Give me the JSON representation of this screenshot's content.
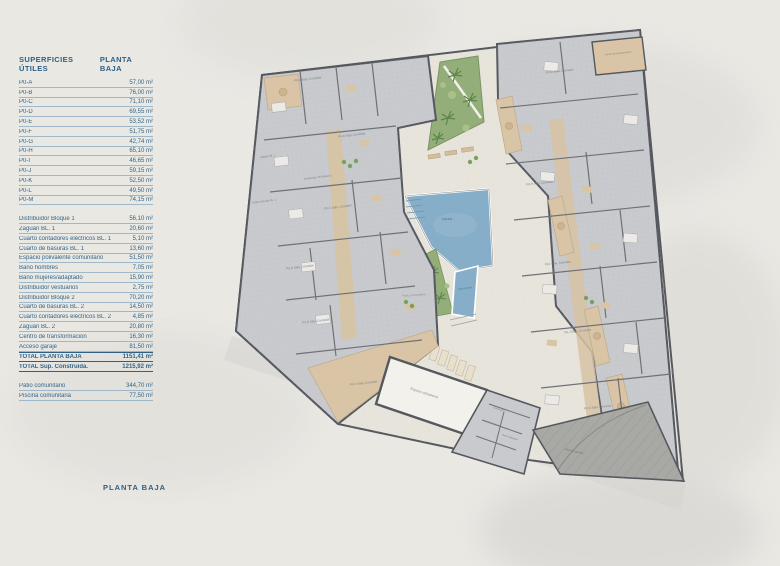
{
  "table": {
    "header_left": "SUPERFICIES ÚTILES",
    "header_right": "PLANTA BAJA",
    "unit_rows": [
      {
        "label": "P0-A",
        "value": "57,00 m²"
      },
      {
        "label": "P0-B",
        "value": "76,00 m²"
      },
      {
        "label": "P0-C",
        "value": "71,10 m²"
      },
      {
        "label": "P0-D",
        "value": "69,55 m²"
      },
      {
        "label": "P0-E",
        "value": "53,52 m²"
      },
      {
        "label": "P0-F",
        "value": "51,75 m²"
      },
      {
        "label": "P0-G",
        "value": "42,74 m²"
      },
      {
        "label": "P0-H",
        "value": "65,10 m²"
      },
      {
        "label": "P0-I",
        "value": "46,65 m²"
      },
      {
        "label": "P0-J",
        "value": "59,15 m²"
      },
      {
        "label": "P0-K",
        "value": "52,50 m²"
      },
      {
        "label": "P0-L",
        "value": "49,50 m²"
      },
      {
        "label": "P0-M",
        "value": "74,15 m²"
      }
    ],
    "common_rows": [
      {
        "label": "Distribuidor Bloque 1",
        "value": "56,10 m²"
      },
      {
        "label": "Zaguán BL. 1",
        "value": "20,60 m²"
      },
      {
        "label": "Cuarto contadores eléctricos BL. 1",
        "value": "5,10 m²"
      },
      {
        "label": "Cuarto de basuras BL. 1",
        "value": "13,60 m²"
      },
      {
        "label": "Espacio polivalente comunitario",
        "value": "51,50 m²"
      },
      {
        "label": "Baño hombres",
        "value": "7,05 m²"
      },
      {
        "label": "Baño mujeres/adaptado",
        "value": "15,90 m²"
      },
      {
        "label": "Distribuidor vestuarios",
        "value": "2,75 m²"
      },
      {
        "label": "Distribuidor Bloque 2",
        "value": "70,20 m²"
      },
      {
        "label": "Cuarto de basuras BL. 2",
        "value": "14,50 m²"
      },
      {
        "label": "Cuarto contadores eléctricos BL. 2",
        "value": "4,85 m²"
      },
      {
        "label": "Zaguán BL. 2",
        "value": "20,80 m²"
      },
      {
        "label": "Centro de transformación",
        "value": "16,30 m²"
      },
      {
        "label": "Acceso garaje",
        "value": "81,50 m²"
      }
    ],
    "total_rows": [
      {
        "label": "TOTAL PLANTA BAJA",
        "value": "1151,41 m²"
      },
      {
        "label": "TOTAL Sup. Construida.",
        "value": "1215,92 m²"
      }
    ],
    "extra_rows": [
      {
        "label": "Patio comunitario",
        "value": "344,70 m²"
      },
      {
        "label": "Piscina comunitaria",
        "value": "77,50 m²"
      }
    ]
  },
  "footer": {
    "title": "PLANTA BAJA"
  },
  "plan": {
    "colors": {
      "text_blue": "#2c5f85",
      "block_gray": "#c8cace",
      "wall": "#55585e",
      "terrace_beige": "#d9c5a6",
      "garden_green": "#93ae78",
      "pool_blue": "#87aec8",
      "ramp_gray": "#a8a8a4"
    },
    "labels": [
      {
        "t": "P0-A Sala. Comedor",
        "x": 308,
        "y": 80,
        "r": -7,
        "s": 3
      },
      {
        "t": "P0-B Sala. Comedor",
        "x": 352,
        "y": 136,
        "r": -7,
        "s": 3
      },
      {
        "t": "P0-C Sala. Comedor",
        "x": 338,
        "y": 208,
        "r": -7,
        "s": 3
      },
      {
        "t": "P0-D Sala. Comedor",
        "x": 300,
        "y": 268,
        "r": -7,
        "s": 3
      },
      {
        "t": "P0-E Sala. Comedor",
        "x": 316,
        "y": 322,
        "r": -7,
        "s": 3
      },
      {
        "t": "P0-F Sala. Comedor",
        "x": 364,
        "y": 384,
        "r": -7,
        "s": 3
      },
      {
        "t": "P0-G Sala. Comedor",
        "x": 560,
        "y": 72,
        "r": -6,
        "s": 3
      },
      {
        "t": "P0-H Sala. Comedor",
        "x": 540,
        "y": 184,
        "r": -6,
        "s": 3
      },
      {
        "t": "P0-I Sala. Comedor",
        "x": 558,
        "y": 264,
        "r": -6,
        "s": 3
      },
      {
        "t": "P0-J Sala. Comedor",
        "x": 578,
        "y": 332,
        "r": -6,
        "s": 3
      },
      {
        "t": "P0-K Sala. Comedor",
        "x": 598,
        "y": 408,
        "r": -6,
        "s": 3
      },
      {
        "t": "Zaguán BL. 1",
        "x": 268,
        "y": 157,
        "r": -7,
        "s": 2.6
      },
      {
        "t": "Distribuidor P0 Bloque 1",
        "x": 318,
        "y": 178,
        "r": -7,
        "s": 2.6
      },
      {
        "t": "Cuarto basuras BL. 1",
        "x": 264,
        "y": 202,
        "r": -7,
        "s": 2.6
      },
      {
        "t": "Patio comunitario",
        "x": 414,
        "y": 296,
        "r": -4,
        "s": 3,
        "c": "#8a8d84"
      },
      {
        "t": "Piscina",
        "x": 447,
        "y": 220,
        "r": -4,
        "s": 3.2,
        "c": "#4b6b80"
      },
      {
        "t": "Piscina infantil",
        "x": 465,
        "y": 289,
        "r": -8,
        "s": 2.2,
        "c": "#4b6b80"
      },
      {
        "t": "Espacio polivalente",
        "x": 424,
        "y": 394,
        "r": 18,
        "s": 3.4,
        "c": "#8a8d84"
      },
      {
        "t": "Distribuidor",
        "x": 499,
        "y": 410,
        "r": 18,
        "s": 2.4
      },
      {
        "t": "Baño hombres",
        "x": 492,
        "y": 424,
        "r": 18,
        "s": 2.4
      },
      {
        "t": "Baño adaptado",
        "x": 510,
        "y": 438,
        "r": 18,
        "s": 2.4
      },
      {
        "t": "Acceso garaje",
        "x": 574,
        "y": 452,
        "r": 13,
        "s": 3,
        "c": "#77776f"
      },
      {
        "t": "Centro de transformación",
        "x": 618,
        "y": 54,
        "r": -6,
        "s": 2.4
      }
    ]
  }
}
